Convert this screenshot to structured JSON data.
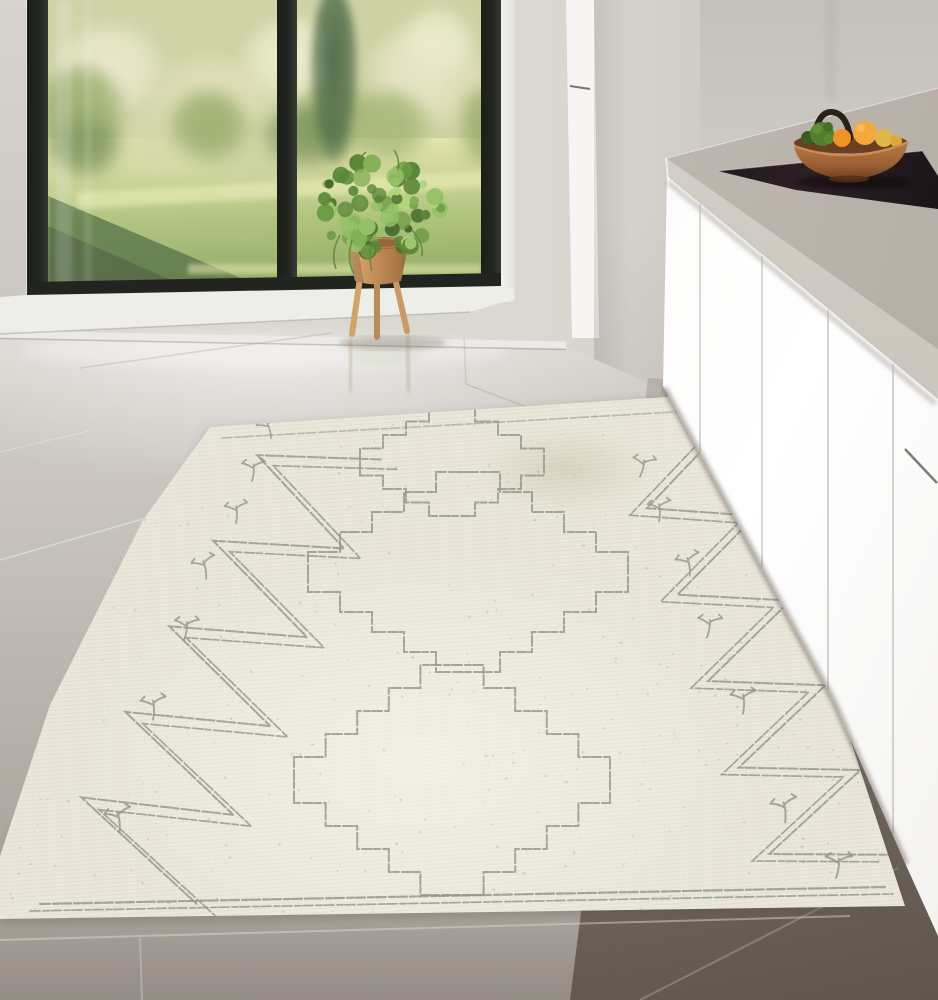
{
  "meta": {
    "domain": "natural-image",
    "subject": "Bright modern kitchen interior: large black-framed window onto a sunlit garden, potted plant on a wooden stand, white cabinets with concrete countertop, black cooktop, wooden fruit bowl, and a cream Moroccan-style area rug on grey tiles",
    "style": "photograph"
  },
  "palette": {
    "wall": "#dbd7d1",
    "wall_shade": "#cfcbc5",
    "frame": "#22251f",
    "reveal": "#f2f1ee",
    "sill": "#edece7",
    "column": "#f4f3f0",
    "canopy_base": "#c9cd9b",
    "conifer": "#3f5d39",
    "lawn_light": "#e2e1a9",
    "lawn_mid": "#abc076",
    "lawn_deep": "#8aa65c",
    "lawn_shadow": "#53703e",
    "floor_light": "#dcd8d3",
    "floor_mid": "#c6c0ba",
    "floor_taupe": "#aaa29b",
    "floor_dark": "#756a62",
    "counter": "#b9b2aa",
    "counter_light": "#cfc9c1",
    "fascia": "#d8d3cc",
    "cooktop": "#171014",
    "cabinet": "#fafaf8",
    "seam": "#c9c7c2",
    "rug": "#eae6da",
    "rug_line": "#8e958a",
    "pot": "#c08a56",
    "pot_light": "#dcae79",
    "leg": "#d2a26d",
    "bowl": "#9c5f33",
    "bowl_rim": "#c98e58",
    "bowl_dark": "#6b3f20",
    "handle": "#2b211a",
    "orange": "#ef9228",
    "orange_light": "#f6a83e",
    "fruit_green": "#527d2e",
    "fruit_green_dark": "#3c5c21",
    "fruit_yellow": "#e0b84a"
  },
  "garden": {
    "tones": [
      "#e9e6c6",
      "#dedbb0",
      "#ecebcb",
      "#d2d4a4",
      "#c8cf9c",
      "#87a058",
      "#6e8a4e",
      "#9ab06a"
    ]
  },
  "plant": {
    "foliage_tones": [
      "#466b2d",
      "#5a8639",
      "#6d9b46",
      "#82b055",
      "#96c268",
      "#b3d47e"
    ]
  },
  "rug": {
    "motifs": [
      "zigzag-border",
      "stepped-diamond-chain",
      "sprout"
    ],
    "diamonds": [
      {
        "cx": 452,
        "cy": 462,
        "rx": 92,
        "ry": 54,
        "steps": 4
      },
      {
        "cx": 468,
        "cy": 572,
        "rx": 160,
        "ry": 100,
        "steps": 5
      },
      {
        "cx": 452,
        "cy": 780,
        "rx": 158,
        "ry": 115,
        "steps": 5
      }
    ],
    "sprouts": [
      [
        268,
        427,
        0.9,
        -15
      ],
      [
        253,
        469,
        0.95,
        5
      ],
      [
        236,
        511,
        0.95,
        0
      ],
      [
        204,
        566,
        1,
        -10
      ],
      [
        186,
        627,
        1,
        8
      ],
      [
        153,
        706,
        1.05,
        0
      ],
      [
        118,
        818,
        1.1,
        -6
      ],
      [
        643,
        465,
        0.95,
        15
      ],
      [
        659,
        509,
        0.95,
        0
      ],
      [
        688,
        563,
        1,
        -8
      ],
      [
        709,
        625,
        1,
        10
      ],
      [
        743,
        700,
        1.05,
        0
      ],
      [
        784,
        808,
        1.1,
        -5
      ],
      [
        838,
        864,
        1.1,
        8
      ]
    ]
  },
  "window_view": {
    "elements": [
      "blossoming-trees",
      "conifer",
      "lawn",
      "tree-shadow-on-lawn"
    ]
  },
  "counter_items": [
    "induction-cooktop",
    "wooden-fruit-bowl"
  ],
  "fruit": {
    "oranges": 3,
    "green": 2,
    "yellow": 1
  }
}
